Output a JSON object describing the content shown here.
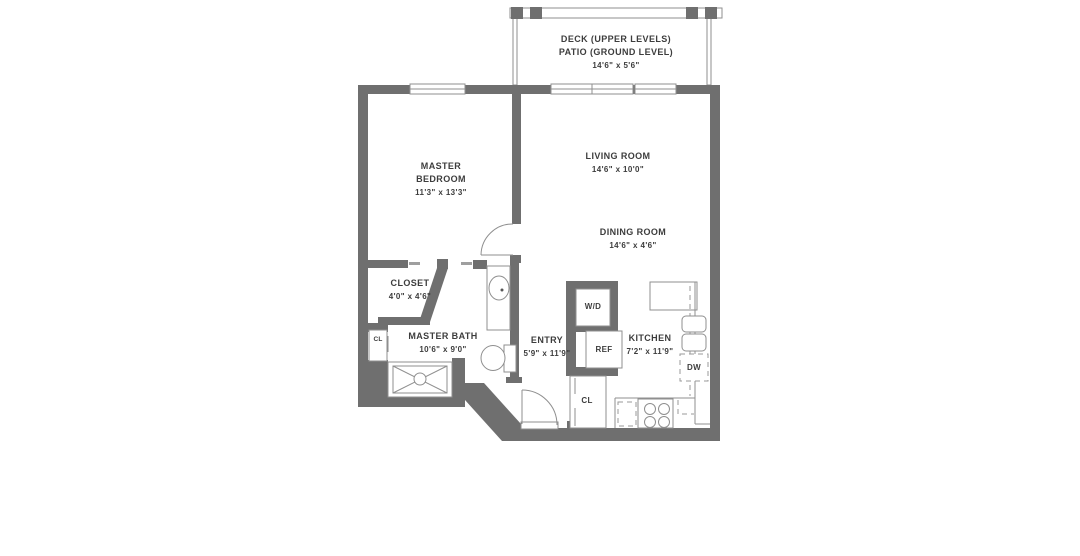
{
  "plan": {
    "title": "one-bedroom apartment floor plan",
    "deck": {
      "line1": "DECK (UPPER LEVELS)",
      "line2": "PATIO (GROUND LEVEL)",
      "dims": "14'6\" x 5'6\""
    },
    "rooms": {
      "master_bedroom": {
        "name_line1": "MASTER",
        "name_line2": "BEDROOM",
        "dims": "11'3\" x 13'3\""
      },
      "living_room": {
        "name": "LIVING ROOM",
        "dims": "14'6\" x 10'0\""
      },
      "dining_room": {
        "name": "DINING ROOM",
        "dims": "14'6\" x 4'6\""
      },
      "closet": {
        "name": "CLOSET",
        "dims": "4'0\" x 4'6\""
      },
      "master_bath": {
        "name": "MASTER BATH",
        "dims": "10'6\" x 9'0\""
      },
      "entry": {
        "name": "ENTRY",
        "dims": "5'9\" x 11'9\""
      },
      "kitchen": {
        "name": "KITCHEN",
        "dims": "7'2\" x 11'9\""
      }
    },
    "appliances": {
      "washer_dryer": "W/D",
      "refrigerator": "REF",
      "dishwasher": "DW",
      "bath_closet": "CL",
      "entry_closet": "CL"
    },
    "colors": {
      "wall": "#6f6f6f",
      "thin_line": "#8f8f8f",
      "text": "#3d3d3d",
      "background": "#ffffff"
    }
  }
}
